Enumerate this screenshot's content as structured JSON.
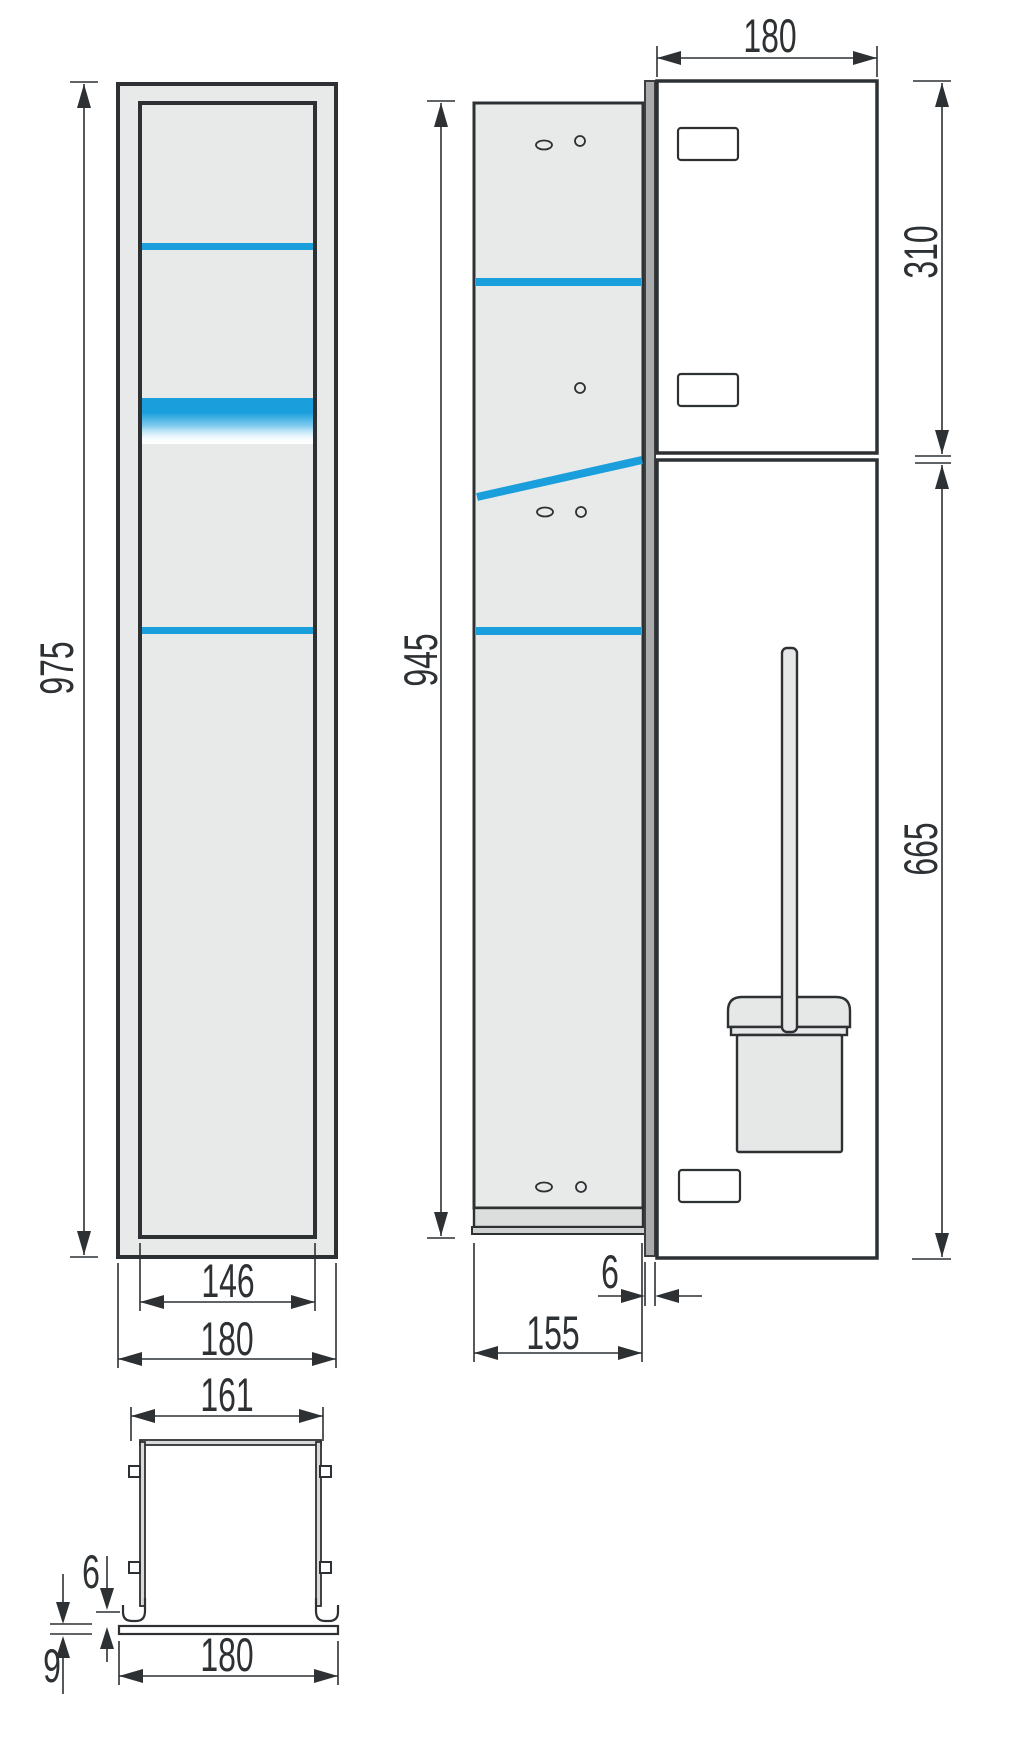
{
  "drawing": {
    "type": "technical-dimension-drawing",
    "subject": "built-in sanitary module (frame front view, side view, door front view with toilet brush set, plan section)",
    "views": {
      "front": "frame-front-view",
      "side": "carcass-side-view",
      "doors": "door-front-view",
      "section": "plan-section-view"
    }
  },
  "dims": {
    "front_height": "975",
    "front_inner_width": "146",
    "front_outer_width": "180",
    "side_height": "945",
    "side_depth": "155",
    "door_thickness": "6",
    "door_width": "180",
    "upper_door_height": "310",
    "lower_door_height": "665",
    "section_inner_width": "161",
    "section_lip_height": "6",
    "section_plate_thickness": "9",
    "section_outer_width": "180"
  },
  "colors": {
    "accent_blue": "#1a9fdc",
    "panel_gray": "#e8eaea",
    "plinth_gray": "#dcdddd",
    "door_edge_gray": "#a9abac",
    "line_dark": "#2d3133"
  }
}
